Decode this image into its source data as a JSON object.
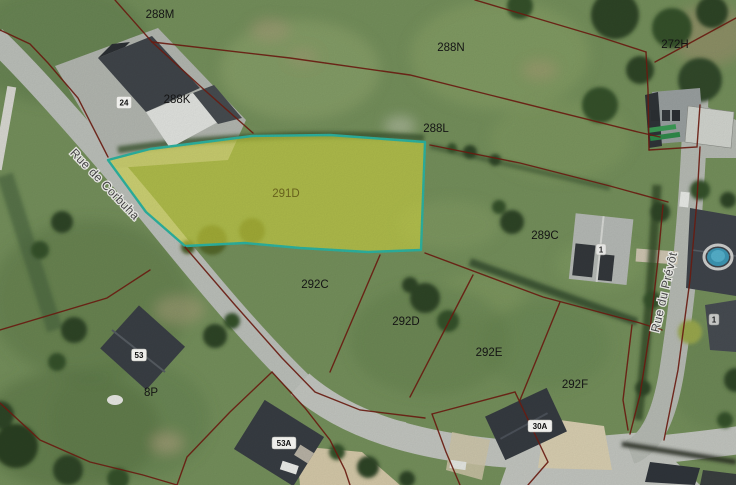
{
  "map": {
    "type": "cadastral-parcel-map-over-aerial-photo",
    "highlighted_parcel_id": "291D",
    "colors": {
      "boundary_line": "#6f1d12",
      "highlight_fill": "#d9dd3f",
      "highlight_stroke": "#2db3a0",
      "road": "#bcc0ba",
      "grass": "#75905c",
      "roof_dark": "#3c4147",
      "parcel_label_text": "#161616",
      "highlight_label_text": "#6e681f",
      "street_label_text": "#4a4a4a"
    },
    "parcel_labels": [
      {
        "id": "288M",
        "text": "288M"
      },
      {
        "id": "288N",
        "text": "288N"
      },
      {
        "id": "272H",
        "text": "272H"
      },
      {
        "id": "288K",
        "text": "288K"
      },
      {
        "id": "288L",
        "text": "288L"
      },
      {
        "id": "291D",
        "text": "291D"
      },
      {
        "id": "289C",
        "text": "289C"
      },
      {
        "id": "292C",
        "text": "292C"
      },
      {
        "id": "292D",
        "text": "292D"
      },
      {
        "id": "292E",
        "text": "292E"
      },
      {
        "id": "292F",
        "text": "292F"
      },
      {
        "id": "8P",
        "text": "8P"
      }
    ],
    "street_labels": [
      {
        "id": "rue-de-corbuha",
        "text": "Rue de Corbuha"
      },
      {
        "id": "rue-du-prevot",
        "text": "Rue du Prévôt"
      }
    ],
    "house_numbers": [
      {
        "text": "24"
      },
      {
        "text": "53"
      },
      {
        "text": "53A"
      },
      {
        "text": "30A"
      },
      {
        "text": "1"
      },
      {
        "text": "1"
      }
    ]
  }
}
